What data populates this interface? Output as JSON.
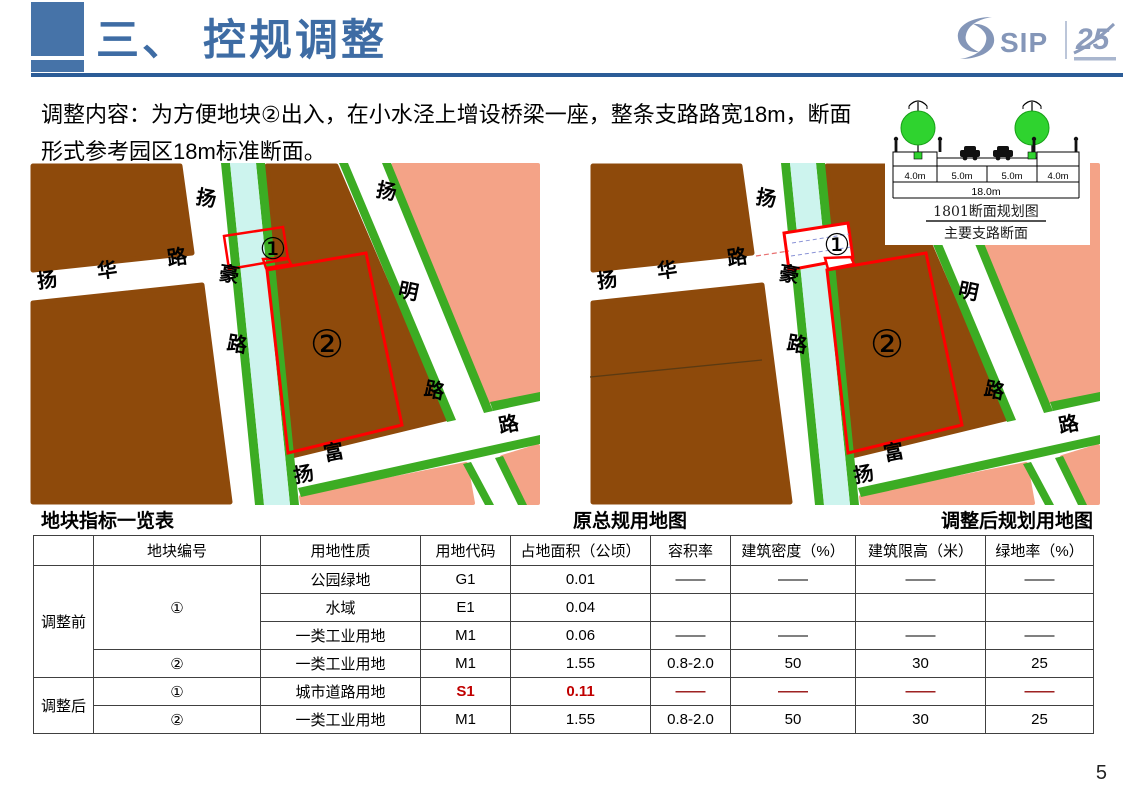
{
  "header": {
    "title": "三、 控规调整",
    "logo_sip": "SIP",
    "logo_25": "25"
  },
  "description": {
    "line1": "调整内容：为方便地块②出入，在小水泾上增设桥梁一座，整条支路路宽18m，断面",
    "line2": "形式参考园区18m标准断面。"
  },
  "section_diagram": {
    "dims": [
      "4.0m",
      "5.0m",
      "5.0m",
      "4.0m"
    ],
    "total": "18.0m",
    "title": "1801断面规划图",
    "subtitle": "主要支路断面"
  },
  "captions": {
    "table": "地块指标一览表",
    "left_map": "原总规用地图",
    "right_map": "调整后规划用地图"
  },
  "map_labels": {
    "yang_hua": "扬",
    "hua": "华",
    "lu_hua": "路",
    "yang_hao": "扬",
    "hao": "豪",
    "lu_hao": "路",
    "yang_ming": "扬",
    "ming": "明",
    "lu_ming": "路",
    "yang_fu": "扬",
    "fu": "富",
    "lu_fu": "路",
    "p1": "①",
    "p2": "②"
  },
  "table": {
    "headers": [
      "",
      "地块编号",
      "用地性质",
      "用地代码",
      "占地面积（公顷）",
      "容积率",
      "建筑密度（%）",
      "建筑限高（米）",
      "绿地率（%）"
    ],
    "group1_label": "调整前",
    "group2_label": "调整后",
    "r1": {
      "parcel": "①",
      "use": "公园绿地",
      "code": "G1",
      "area": "0.01",
      "far": "——",
      "density": "——",
      "limit": "——",
      "green": "——"
    },
    "r2": {
      "use": "水域",
      "code": "E1",
      "area": "0.04"
    },
    "r3": {
      "use": "一类工业用地",
      "code": "M1",
      "area": "0.06",
      "far": "——",
      "density": "——",
      "limit": "——",
      "green": "——"
    },
    "r4": {
      "parcel": "②",
      "use": "一类工业用地",
      "code": "M1",
      "area": "1.55",
      "far": "0.8-2.0",
      "density": "50",
      "limit": "30",
      "green": "25"
    },
    "r5": {
      "parcel": "①",
      "use": "城市道路用地",
      "code": "S1",
      "area": "0.11",
      "far": "——",
      "density": "——",
      "limit": "——",
      "green": "——"
    },
    "r6": {
      "parcel": "②",
      "use": "一类工业用地",
      "code": "M1",
      "area": "1.55",
      "far": "0.8-2.0",
      "density": "50",
      "limit": "30",
      "green": "25"
    }
  },
  "footer": {
    "page": "5"
  },
  "colors": {
    "accent_blue": "#4673A8",
    "rule_blue": "#2B5C97",
    "logo_blue_grey": "#8496B8",
    "highlight_red": "#C00000",
    "outline_red": "#FF0000",
    "map_industrial_brown": "#8E4A0B",
    "map_residential_pink": "#F4A387",
    "map_green": "#3CAC23",
    "map_river_cyan": "#CDF4EE"
  }
}
